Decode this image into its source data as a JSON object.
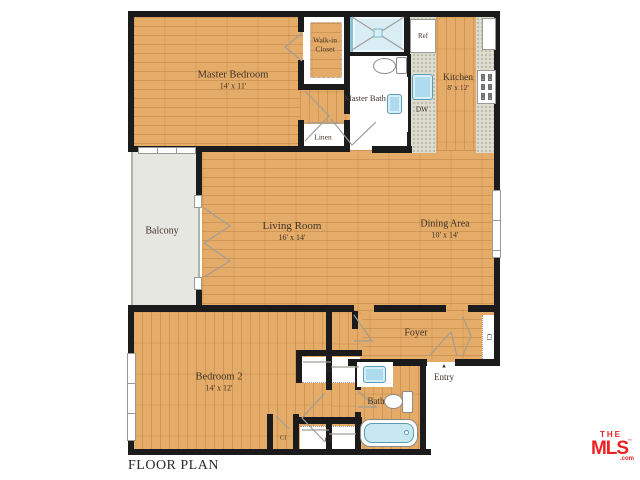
{
  "title": "FLOOR PLAN",
  "rooms": {
    "master_bedroom": {
      "name": "Master Bedroom",
      "dims": "14' x 11'"
    },
    "walk_in_closet": {
      "name": "Walk-in Closet"
    },
    "master_bath": {
      "name": "Master Bath"
    },
    "linen": {
      "name": "Linen"
    },
    "kitchen": {
      "name": "Kitchen",
      "dims": "8' x 12'"
    },
    "balcony": {
      "name": "Balcony"
    },
    "living_room": {
      "name": "Living Room",
      "dims": "16' x 14'"
    },
    "dining_area": {
      "name": "Dining Area",
      "dims": "10' x 14'"
    },
    "foyer": {
      "name": "Foyer"
    },
    "bedroom_2": {
      "name": "Bedroom 2",
      "dims": "14' x 12'"
    },
    "bath": {
      "name": "Bath"
    },
    "entry": {
      "name": "Entry",
      "arrow": "▲"
    }
  },
  "appliances": {
    "refrigerator": "Ref",
    "dishwasher": "DW"
  },
  "closet_abbr": "Cl",
  "fixtures": [
    "shower",
    "toilet",
    "sink",
    "bathtub",
    "stove",
    "refrigerator",
    "dishwasher"
  ],
  "branding": {
    "line1": "THE",
    "line2": "MLS",
    "tm": "™",
    "suffix": ".com"
  },
  "colors": {
    "wood": "#e5ac69",
    "wall": "#1b1b1b",
    "outdoor": "#e7e7e2",
    "counter": "#dcdccf",
    "water_fixture": "#c7e7f1",
    "logo_red": "#ed2024"
  }
}
